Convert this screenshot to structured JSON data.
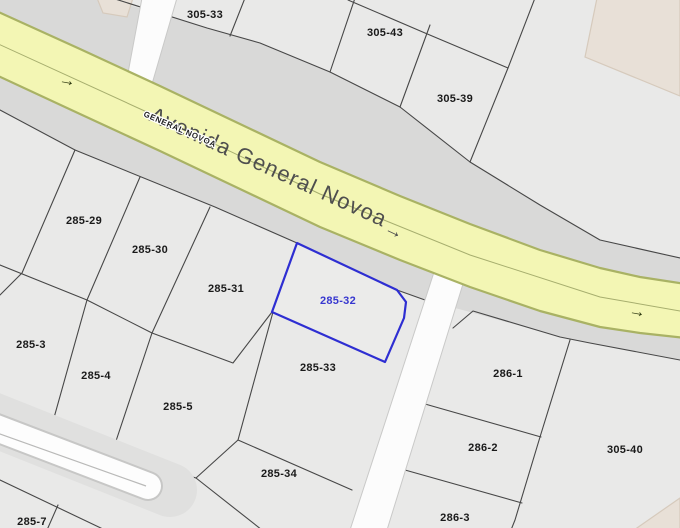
{
  "street": {
    "name": "Avenida General Novoa",
    "name_caps": "GENERAL NOVOA",
    "arrow": "→"
  },
  "selected_parcel": {
    "id": "285-32"
  },
  "parcel_labels": [
    "305-33",
    "305-43",
    "305-39",
    "285-29",
    "285-30",
    "285-31",
    "285-33",
    "285-3",
    "285-4",
    "285-5",
    "285-34",
    "285-7",
    "286-1",
    "286-2",
    "286-3",
    "305-40"
  ],
  "colors": {
    "background": "#e9e9e8",
    "street_corridor": "#d9d9d8",
    "road_fill": "#f3f6b4",
    "road_border": "#a9b264",
    "selected_outline": "#2e2ed2",
    "selected_label": "#3737cf",
    "building": "#e8e0d7"
  }
}
